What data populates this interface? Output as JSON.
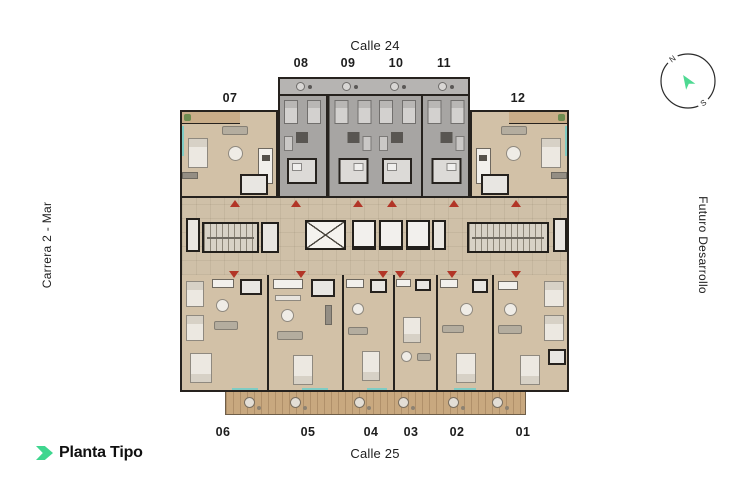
{
  "streets": {
    "top": "Calle 24",
    "bottom": "Calle 25"
  },
  "sides": {
    "left": "Carrera 2 - Mar",
    "right": "Futuro Desarrollo"
  },
  "logo": {
    "text": "Planta Tipo"
  },
  "compass": {
    "north_label": "N",
    "south_label": "S"
  },
  "plan": {
    "units_top": [
      "08",
      "09",
      "10",
      "11"
    ],
    "unit_left": "07",
    "unit_right": "12",
    "units_bottom": [
      "06",
      "05",
      "04",
      "03",
      "02",
      "01"
    ]
  },
  "colors": {
    "accent_green": "#3fd68f",
    "entrance_marker_red": "#b23527",
    "floor_beige": "#d2c1a7",
    "floor_gray": "#a7a5a3",
    "corridor_floor": "#cfc0a8",
    "balcony_wood": "#c8a87f",
    "wall_dark": "#26221e",
    "window_teal": "#7fccc4",
    "text_dark": "#1d1d1d"
  }
}
